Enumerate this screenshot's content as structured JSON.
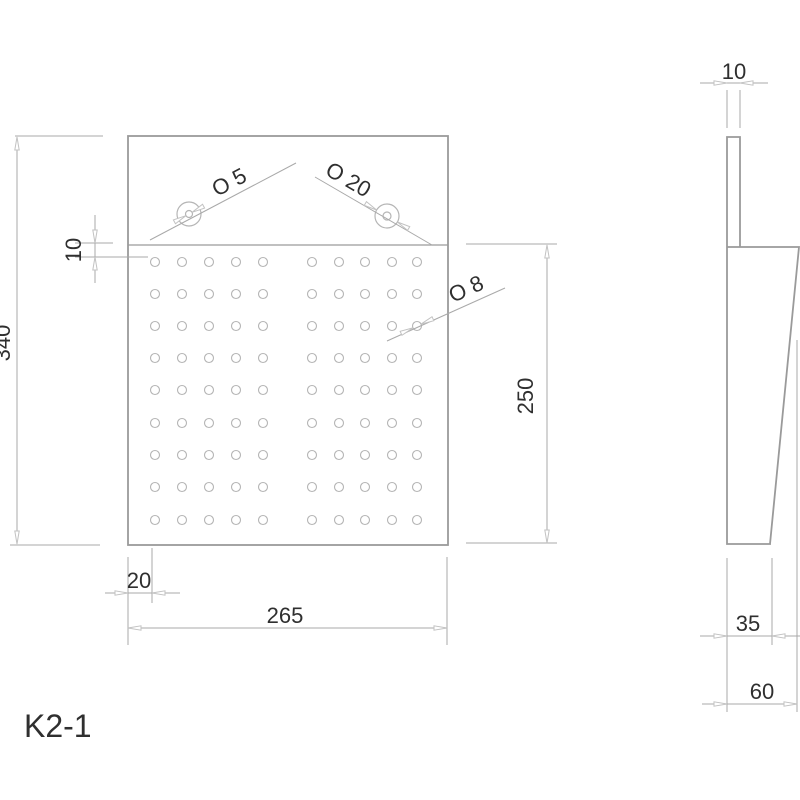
{
  "drawing_title": "K2-1",
  "front_view": {
    "dim_height": "340",
    "dim_hole_field_height": "250",
    "dim_width": "265",
    "dim_edge_offset": "20",
    "dim_strip_offset": "10",
    "label_small_hole": "O 5",
    "label_large_hole": "O 20",
    "label_grid_hole": "O 8",
    "hole_grid": {
      "cols_x": [
        155,
        182,
        209,
        236,
        263,
        312,
        339,
        365,
        392,
        417
      ],
      "rows_y": [
        262,
        294,
        326,
        358,
        390,
        423,
        455,
        487,
        520
      ],
      "hole_radius": 4.5
    }
  },
  "side_view": {
    "dim_thickness": "10",
    "dim_bottom_width": "35",
    "dim_top_width": "60"
  },
  "colors": {
    "outline": "#9a9a9a",
    "dimension_line": "#a9a9a9",
    "hole_circle": "#b5b5b5",
    "arrow": "#c2c2c2",
    "text": "#2f2f2f"
  }
}
